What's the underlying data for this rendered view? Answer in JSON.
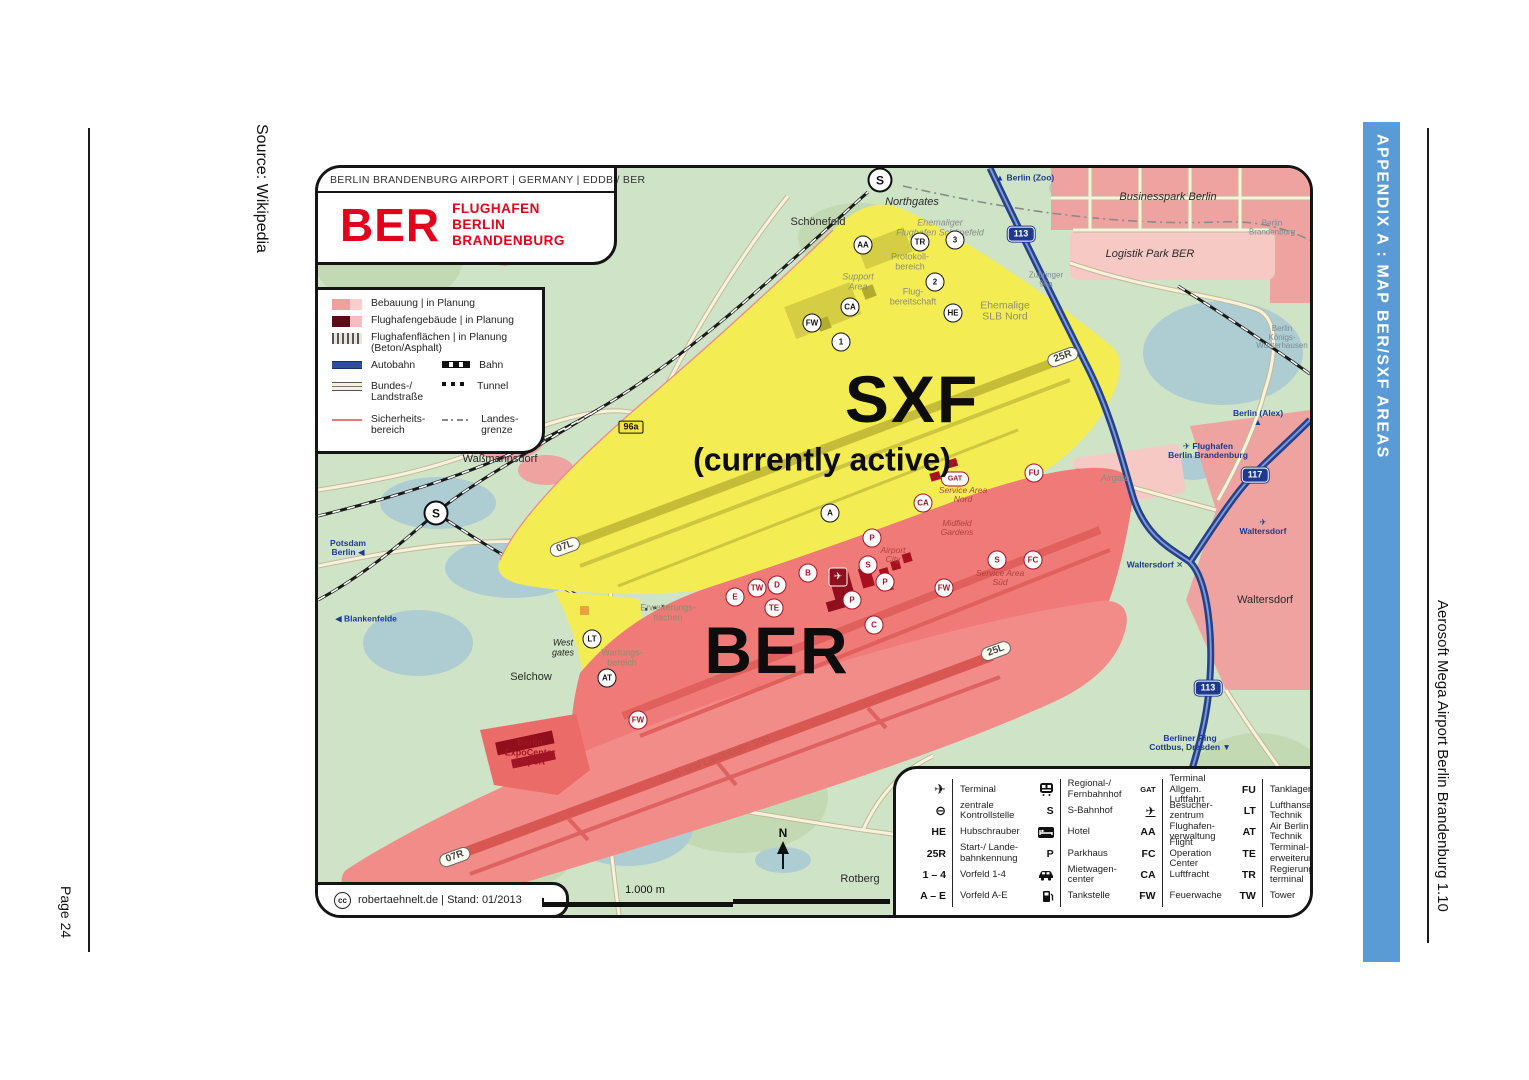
{
  "page": {
    "left_margin": {
      "source": "Source: Wikipedia",
      "page_number": "Page 24"
    },
    "right_margin": {
      "appendix_banner": "APPENDIX A : MAP BER/SXF AREAS",
      "footer": "Aerosoft Mega Airport Berlin Brandenburg 1.10"
    }
  },
  "colors": {
    "banner": "#5b9bd5",
    "map_green": "#cfe3c6",
    "logo_red": "#e2001a",
    "sxf_yellow": "#f3ed53",
    "ber_red": "#ef7a77",
    "motorway_blue": "#24418c",
    "badge_blue": "#1d3a8f",
    "urban_pink": "#efa3a1",
    "water_blue": "#aecdd3"
  },
  "map": {
    "header": "BERLIN BRANDENBURG AIRPORT  |  GERMANY  |  EDDB / BER",
    "logo": {
      "code": "BER",
      "name": "FLUGHAFEN\nBERLIN\nBRANDENBURG"
    },
    "area_labels": {
      "sxf": "SXF",
      "sxf_note": "(currently active)",
      "ber": "BER"
    },
    "attribution": {
      "badge": "cc",
      "text": "robertaehnelt.de  |  Stand: 01/2013"
    },
    "scale": {
      "label": "1.000 m"
    },
    "compass": "N",
    "legend": {
      "full_rows": [
        {
          "swatch": "bebauung",
          "label": "Bebauung | in Planung"
        },
        {
          "swatch": "gebaeude",
          "label": "Flughafengebäude | in Planung"
        },
        {
          "swatch": "flaechen",
          "label": "Flughafenflächen | in Planung\n(Beton/Asphalt)"
        }
      ],
      "pair_rows": [
        [
          {
            "swatch": "autobahn",
            "label": "Autobahn"
          },
          {
            "swatch": "bahn",
            "label": "Bahn"
          }
        ],
        [
          {
            "swatch": "landstrasse",
            "label": "Bundes-/\nLandstraße"
          },
          {
            "swatch": "tunnel",
            "label": "Tunnel"
          }
        ],
        [
          {
            "swatch": "sicherheit",
            "label": "Sicherheits-\nbereich"
          },
          {
            "swatch": "grenze",
            "label": "Landes-\ngrenze"
          }
        ]
      ]
    },
    "labels": [
      {
        "text": "Schönefeld",
        "x": 500,
        "y": 55,
        "cls": "l-town"
      },
      {
        "text": "Northgates",
        "x": 594,
        "y": 35,
        "cls": "l-town l-it"
      },
      {
        "text": "Ehemaliger\nFlughafen Schönefeld",
        "x": 622,
        "y": 60,
        "cls": "l-g2 l-it"
      },
      {
        "text": "▲ Berlin (Zoo)",
        "x": 707,
        "y": 10,
        "cls": "l-blue"
      },
      {
        "text": "Businesspark Berlin",
        "x": 850,
        "y": 30,
        "cls": "l-town l-it"
      },
      {
        "text": "Berlin\nBrandenburg",
        "x": 954,
        "y": 60,
        "cls": "l-tiny"
      },
      {
        "text": "Logistik Park BER",
        "x": 832,
        "y": 87,
        "cls": "l-town l-it"
      },
      {
        "text": "Berlin\nKönigs-\nWusterhausen",
        "x": 964,
        "y": 170,
        "cls": "l-tiny"
      },
      {
        "text": "Zubringer\n96a",
        "x": 728,
        "y": 112,
        "cls": "l-tiny"
      },
      {
        "text": "Protokoll-\nbereich",
        "x": 592,
        "y": 94,
        "cls": "l-gray"
      },
      {
        "text": "Flug-\nbereitschaft",
        "x": 595,
        "y": 129,
        "cls": "l-gray"
      },
      {
        "text": "Support\nArea",
        "x": 540,
        "y": 114,
        "cls": "l-gray l-it"
      },
      {
        "text": "Ehemalige\nSLB Nord",
        "x": 687,
        "y": 144,
        "cls": "l-gray l-md"
      },
      {
        "text": "Waßmannsdorf",
        "x": 182,
        "y": 292,
        "cls": "l-town"
      },
      {
        "text": "Potsdam\nBerlin ◀",
        "x": 30,
        "y": 380,
        "cls": "l-blue"
      },
      {
        "text": "◀ Blankenfelde",
        "x": 48,
        "y": 451,
        "cls": "l-blue"
      },
      {
        "text": "Selchow",
        "x": 213,
        "y": 510,
        "cls": "l-town"
      },
      {
        "text": "West\ngates",
        "x": 245,
        "y": 480,
        "cls": "l-sm l-it"
      },
      {
        "text": "Wartungs-\nbereich",
        "x": 304,
        "y": 490,
        "cls": "l-gray"
      },
      {
        "text": "Erweiterungs-\nflächen",
        "x": 350,
        "y": 445,
        "cls": "l-gray"
      },
      {
        "text": "Berlin\nExpoCenter\nAirport",
        "x": 212,
        "y": 585,
        "cls": "l-red"
      },
      {
        "text": "Rotberg",
        "x": 542,
        "y": 712,
        "cls": "l-town"
      },
      {
        "text": "Start- und Landebahn Süd",
        "x": 397,
        "y": 592,
        "cls": "l-rot",
        "rot": -21
      },
      {
        "text": "Airport\nCity",
        "x": 575,
        "y": 387,
        "cls": "l-redit"
      },
      {
        "text": "Midfield\nGardens",
        "x": 639,
        "y": 360,
        "cls": "l-redit"
      },
      {
        "text": "Service Area\nNord",
        "x": 645,
        "y": 327,
        "cls": "l-redit"
      },
      {
        "text": "Service Area\nSüd",
        "x": 682,
        "y": 410,
        "cls": "l-redit"
      },
      {
        "text": "Airgate",
        "x": 797,
        "y": 311,
        "cls": "l-g2 l-it"
      },
      {
        "text": "Berlin (Alex) ▲",
        "x": 940,
        "y": 250,
        "cls": "l-blue"
      },
      {
        "text": "✈ Flughafen\nBerlin Brandenburg",
        "x": 890,
        "y": 283,
        "cls": "l-blue"
      },
      {
        "text": "✈ Waltersdorf",
        "x": 945,
        "y": 359,
        "cls": "l-blue"
      },
      {
        "text": "Waltersdorf ✕",
        "x": 837,
        "y": 397,
        "cls": "l-blue"
      },
      {
        "text": "Waltersdorf",
        "x": 947,
        "y": 433,
        "cls": "l-town"
      },
      {
        "text": "Berliner Ring\nCottbus, Dresden ▼",
        "x": 872,
        "y": 575,
        "cls": "l-blue"
      }
    ],
    "badges": [
      {
        "text": "96a",
        "x": 313,
        "y": 259,
        "kind": "road"
      },
      {
        "text": "113",
        "x": 703,
        "y": 66,
        "kind": "motorway"
      },
      {
        "text": "113",
        "x": 890,
        "y": 520,
        "kind": "motorway"
      },
      {
        "text": "117",
        "x": 937,
        "y": 307,
        "kind": "motorway"
      },
      {
        "text": "25R",
        "x": 745,
        "y": 189,
        "kind": "runway",
        "rot": -20
      },
      {
        "text": "07L",
        "x": 247,
        "y": 379,
        "kind": "runway",
        "rot": -20
      },
      {
        "text": "25L",
        "x": 678,
        "y": 483,
        "kind": "runway",
        "rot": -20
      },
      {
        "text": "07R",
        "x": 137,
        "y": 689,
        "kind": "runway",
        "rot": -20
      }
    ],
    "markers": [
      {
        "text": "S",
        "x": 562,
        "y": 12,
        "theme": "dark",
        "mod": "big",
        "name": "sbahn-station-icon"
      },
      {
        "text": "S",
        "x": 118,
        "y": 345,
        "theme": "dark",
        "mod": "big",
        "name": "sbahn-station-icon"
      },
      {
        "text": "AA",
        "x": 545,
        "y": 77,
        "theme": "dark"
      },
      {
        "text": "TR",
        "x": 602,
        "y": 74,
        "theme": "dark"
      },
      {
        "text": "3",
        "x": 637,
        "y": 72,
        "theme": "dark"
      },
      {
        "text": "2",
        "x": 617,
        "y": 114,
        "theme": "dark"
      },
      {
        "text": "CA",
        "x": 532,
        "y": 139,
        "theme": "dark"
      },
      {
        "text": "FW",
        "x": 494,
        "y": 155,
        "theme": "dark"
      },
      {
        "text": "1",
        "x": 523,
        "y": 174,
        "theme": "dark"
      },
      {
        "text": "HE",
        "x": 635,
        "y": 145,
        "theme": "dark"
      },
      {
        "text": "A",
        "x": 512,
        "y": 345,
        "theme": "dark"
      },
      {
        "text": "LT",
        "x": 274,
        "y": 471,
        "theme": "dark"
      },
      {
        "text": "AT",
        "x": 289,
        "y": 510,
        "theme": "dark"
      },
      {
        "text": "GAT",
        "x": 637,
        "y": 311,
        "theme": "red",
        "mod": "wide"
      },
      {
        "text": "CA",
        "x": 605,
        "y": 335,
        "theme": "red"
      },
      {
        "text": "B",
        "x": 490,
        "y": 405,
        "theme": "red"
      },
      {
        "text": "TW",
        "x": 439,
        "y": 420,
        "theme": "red"
      },
      {
        "text": "D",
        "x": 459,
        "y": 417,
        "theme": "red"
      },
      {
        "text": "E",
        "x": 417,
        "y": 429,
        "theme": "red"
      },
      {
        "text": "TE",
        "x": 456,
        "y": 440,
        "theme": "red"
      },
      {
        "text": "C",
        "x": 556,
        "y": 457,
        "theme": "red"
      },
      {
        "text": "FW",
        "x": 320,
        "y": 552,
        "theme": "red"
      },
      {
        "text": "FW",
        "x": 626,
        "y": 420,
        "theme": "red"
      },
      {
        "text": "FC",
        "x": 715,
        "y": 392,
        "theme": "red"
      },
      {
        "text": "S",
        "x": 679,
        "y": 392,
        "theme": "red"
      },
      {
        "text": "FU",
        "x": 716,
        "y": 305,
        "theme": "red"
      },
      {
        "text": "S",
        "x": 550,
        "y": 397,
        "theme": "red"
      },
      {
        "text": "P",
        "x": 554,
        "y": 370,
        "theme": "red"
      },
      {
        "text": "P",
        "x": 567,
        "y": 414,
        "theme": "red"
      },
      {
        "text": "P",
        "x": 534,
        "y": 432,
        "theme": "red"
      },
      {
        "text": "✈",
        "x": 520,
        "y": 409,
        "theme": "red",
        "mod": "sq",
        "name": "terminal-icon"
      }
    ],
    "symbol_legend": {
      "columns": [
        {
          "entries": [
            {
              "icon": "terminal-icon",
              "label": "Terminal"
            },
            {
              "icon": "checkpoint-icon",
              "label": "zentrale\nKontrollstelle"
            },
            {
              "sym": "HE",
              "label": "Hubschrauber"
            },
            {
              "sym": "25R",
              "label": "Start-/ Lande-\nbahnkennung"
            },
            {
              "sym": "1 – 4",
              "label": "Vorfeld 1-4"
            },
            {
              "sym": "A – E",
              "label": "Vorfeld A-E"
            }
          ]
        },
        {
          "entries": [
            {
              "icon": "train-icon",
              "label": "Regional-/\nFernbahnhof"
            },
            {
              "sym": "S",
              "label": "S-Bahnhof"
            },
            {
              "icon": "hotel-icon",
              "label": "Hotel"
            },
            {
              "sym": "P",
              "label": "Parkhaus"
            },
            {
              "icon": "car-icon",
              "label": "Mietwagen-\ncenter"
            },
            {
              "icon": "fuel-icon",
              "label": "Tankstelle"
            }
          ]
        },
        {
          "entries": [
            {
              "sym": "GAT",
              "small": true,
              "label": "Terminal\nAllgem. Luftfahrt"
            },
            {
              "icon": "visitor-icon",
              "label": "Besucher-\nzentrum"
            },
            {
              "sym": "AA",
              "label": "Flughafen-\nverwaltung"
            },
            {
              "sym": "FC",
              "label": "Flight Operation\nCenter"
            },
            {
              "sym": "CA",
              "label": "Luftfracht"
            },
            {
              "sym": "FW",
              "label": "Feuerwache"
            }
          ]
        },
        {
          "entries": [
            {
              "sym": "FU",
              "label": "Tanklager"
            },
            {
              "sym": "LT",
              "label": "Lufthansa\nTechnik"
            },
            {
              "sym": "AT",
              "label": "Air Berlin\nTechnik"
            },
            {
              "sym": "TE",
              "label": "Terminal-\nerweiterungen"
            },
            {
              "sym": "TR",
              "label": "Regierungs-\nterminal"
            },
            {
              "sym": "TW",
              "label": "Tower"
            }
          ]
        }
      ]
    }
  }
}
